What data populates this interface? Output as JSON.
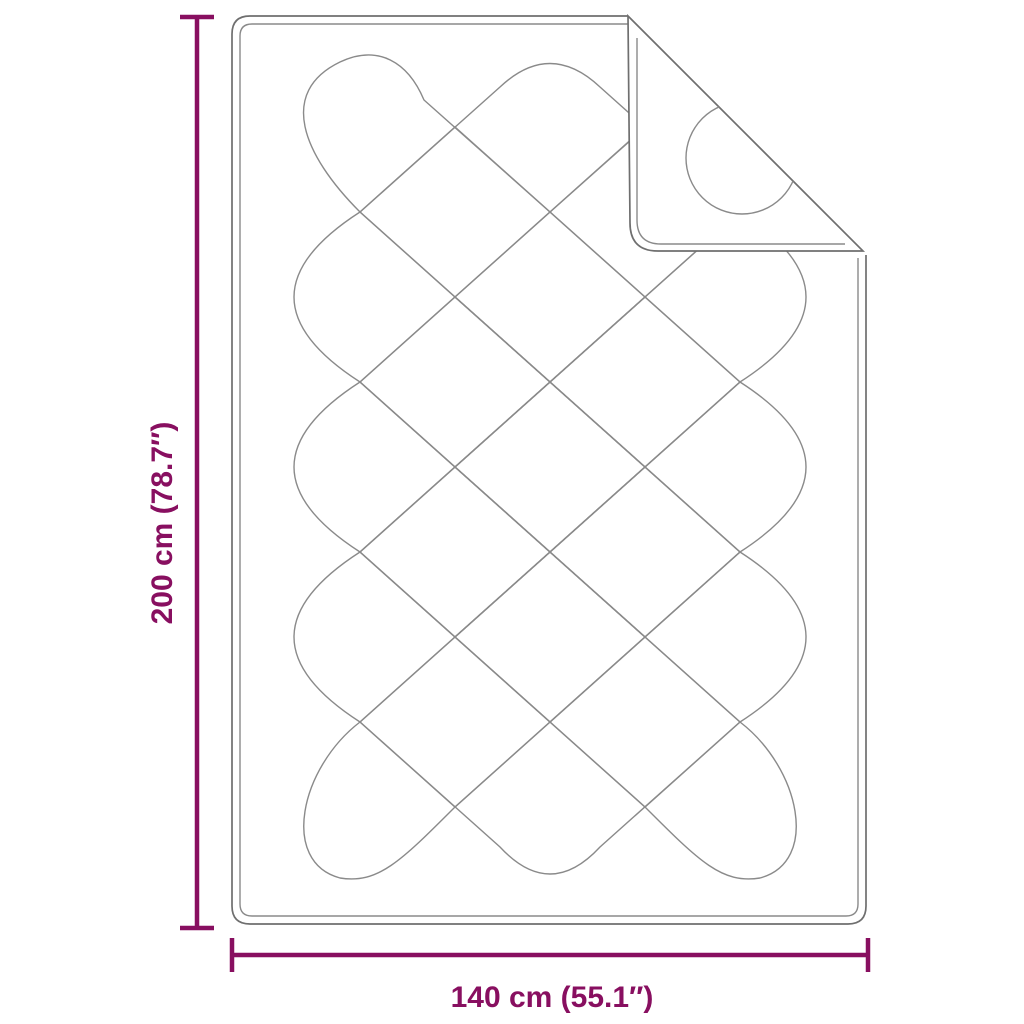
{
  "diagram": {
    "type": "product-dimension-diagram",
    "product": "quilted mattress pad with folded corner",
    "background_color": "#ffffff",
    "accent_color": "#880F60",
    "outline_color": "#6f6f6f",
    "pattern_color": "#8a8a8a",
    "dimensions": {
      "height_label": "200 cm (78.7″)",
      "width_label": "140 cm (55.1″)"
    }
  }
}
